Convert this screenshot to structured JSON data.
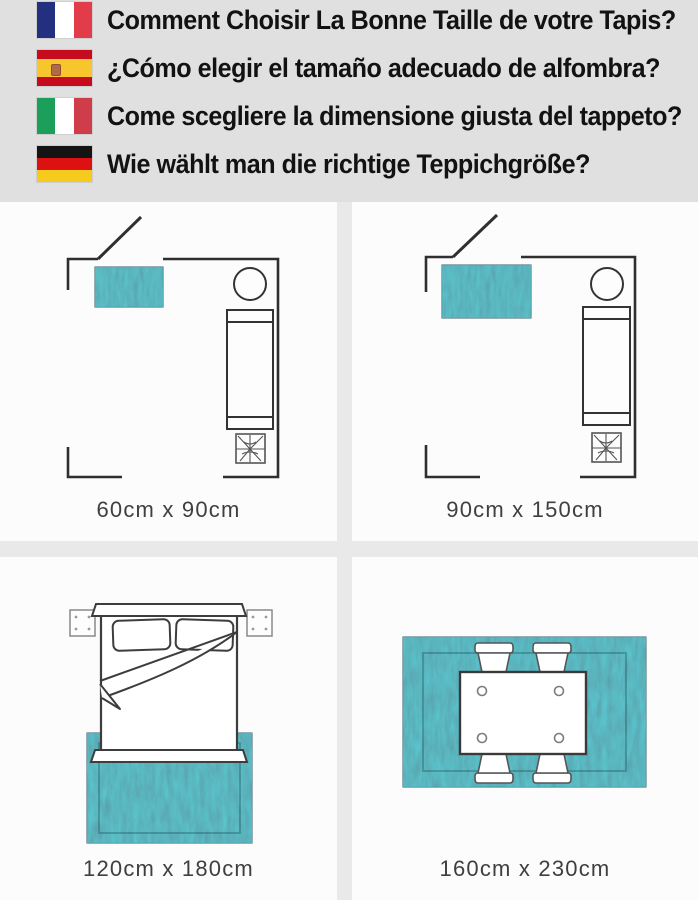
{
  "header": {
    "rows": [
      {
        "lang": "french",
        "flag": "france-flag-icon",
        "text": "Comment Choisir La Bonne Taille de votre Tapis?"
      },
      {
        "lang": "spanish",
        "flag": "spain-flag-icon",
        "text": "¿Cómo elegir el tamaño adecuado de alfombra?"
      },
      {
        "lang": "italian",
        "flag": "italy-flag-icon",
        "text": "Come scegliere la dimensione giusta del tappeto?"
      },
      {
        "lang": "german",
        "flag": "germany-flag-icon",
        "text": "Wie wählt man die richtige Teppichgröße?"
      }
    ]
  },
  "panels": [
    {
      "scene": "room-plan-small-rug",
      "label": "60cm x 90cm"
    },
    {
      "scene": "room-plan-medium-rug",
      "label": "90cm x 150cm"
    },
    {
      "scene": "bedroom-rug",
      "label": "120cm x 180cm"
    },
    {
      "scene": "dining-room-rug",
      "label": "160cm x 230cm"
    }
  ],
  "colors": {
    "header_bg": "#e0e0e0",
    "panel_bg": "#fcfcfc",
    "gutter": "#e9e9e9",
    "line": "#2f2f2f",
    "rug_teal": "#4a7d88",
    "rug_border": "#35616c",
    "label_text": "#3f3f3f",
    "flag_france": [
      "#23307f",
      "#ffffff",
      "#e23b49"
    ],
    "flag_spain": [
      "#c60b1e",
      "#f6c62c"
    ],
    "flag_italy": [
      "#1d9f5c",
      "#ffffff",
      "#cf3c4a"
    ],
    "flag_germany": [
      "#141414",
      "#dd1111",
      "#f7cb1e"
    ]
  }
}
